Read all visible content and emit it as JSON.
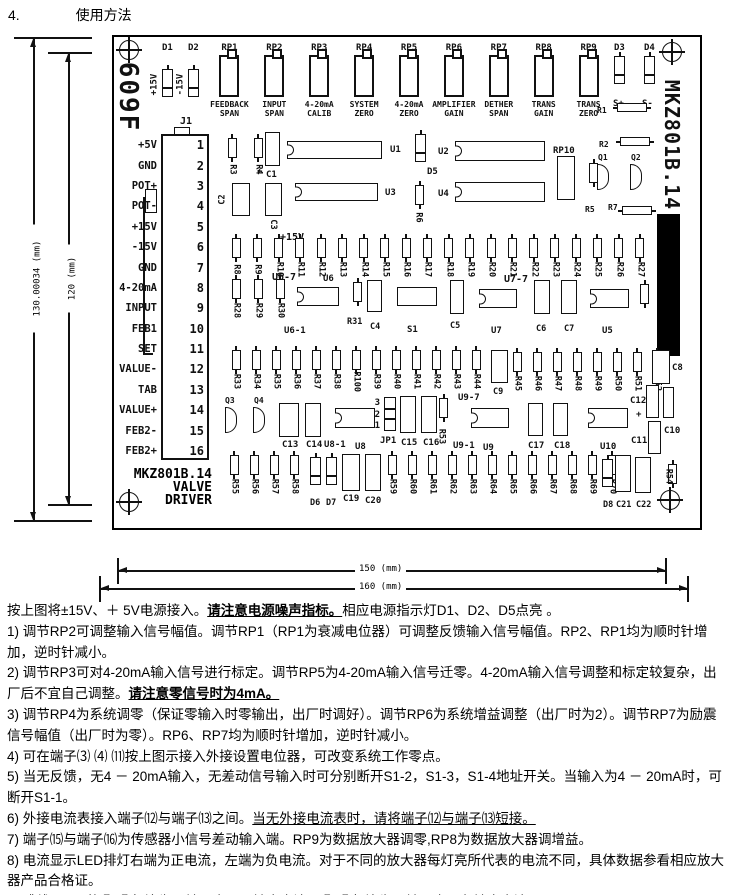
{
  "header": {
    "number": "4.",
    "title": "使用方法"
  },
  "dims": {
    "h_outer": "130.00034 (mm)",
    "h_inner": "120 (mm)",
    "w_inner": "150 (mm)",
    "w_outer": "160 (mm)"
  },
  "board": {
    "side_left": "609F",
    "side_right": "MKZ801B.14",
    "title_block": [
      "MKZ801B.14",
      "VALVE",
      "DRIVER"
    ],
    "l": {
      "d1": "D1",
      "d2": "D2",
      "d3": "D3",
      "d4": "D4",
      "d5": "D5",
      "d6": "D6",
      "d7": "D7",
      "d8": "D8",
      "p15": "+15V",
      "m15": "-15V",
      "p15_mid": "+15V",
      "sp": "S+",
      "sm": "S-",
      "r1": "R1",
      "r2": "R2",
      "r5": "R5",
      "r6": "R6",
      "r7": "R7",
      "r31": "R31",
      "r53": "R53",
      "r54": "R54",
      "rp10": "RP10",
      "q1": "Q1",
      "q2": "Q2",
      "q3": "Q3",
      "q4": "Q4",
      "j1": "J1",
      "jp1": "JP1",
      "s1": "S1",
      "u1": "U1",
      "u2": "U2",
      "u3": "U3",
      "u4": "U4",
      "u5": "U5",
      "u6": "U6",
      "u7": "U7",
      "u8": "U8",
      "u9": "U9",
      "u10": "U10",
      "u6_7": "U6-7",
      "u6_1": "U6-1",
      "u7_7": "U7-7",
      "u8_1": "U8-1",
      "u9_7": "U9-7",
      "u9_1": "U9-1",
      "c1": "C1",
      "c2": "C2",
      "c3": "C3",
      "c4": "C4",
      "c5": "C5",
      "c6": "C6",
      "c7": "C7",
      "c8": "C8",
      "c9": "C9",
      "c10": "C10",
      "c11": "C11",
      "c12": "C12",
      "c13": "C13",
      "c14": "C14",
      "c15": "C15",
      "c16": "C16",
      "c17": "C17",
      "c18": "C18",
      "c19": "C19",
      "c20": "C20",
      "c21": "C21",
      "c22": "C22",
      "plus": "+"
    },
    "jp_pins": [
      "3",
      "2",
      "1"
    ],
    "pots": [
      {
        "name": "RP1",
        "caption": [
          "FEEDBACK",
          "SPAN"
        ]
      },
      {
        "name": "RP2",
        "caption": [
          "INPUT",
          "SPAN"
        ]
      },
      {
        "name": "RP3",
        "caption": [
          "4-20mA",
          "CALIB"
        ]
      },
      {
        "name": "RP4",
        "caption": [
          "SYSTEM",
          "ZERO"
        ]
      },
      {
        "name": "RP5",
        "caption": [
          "4-20mA",
          "ZERO"
        ]
      },
      {
        "name": "RP6",
        "caption": [
          "AMPLIFIER",
          "GAIN"
        ]
      },
      {
        "name": "RP7",
        "caption": [
          "DETHER",
          "SPAN"
        ]
      },
      {
        "name": "RP8",
        "caption": [
          "TRANS",
          "GAIN"
        ]
      },
      {
        "name": "RP9",
        "caption": [
          "TRANS",
          "ZERO"
        ]
      }
    ],
    "j1_pins": [
      {
        "n": "1",
        "label": "+5V"
      },
      {
        "n": "2",
        "label": "GND"
      },
      {
        "n": "3",
        "label": "POT+"
      },
      {
        "n": "4",
        "label": "POT-"
      },
      {
        "n": "5",
        "label": "+15V"
      },
      {
        "n": "6",
        "label": "-15V"
      },
      {
        "n": "7",
        "label": "GND"
      },
      {
        "n": "8",
        "label": "4-20mA"
      },
      {
        "n": "9",
        "label": "INPUT"
      },
      {
        "n": "10",
        "label": "FEB1"
      },
      {
        "n": "11",
        "label": "SET"
      },
      {
        "n": "12",
        "label": "VALUE-"
      },
      {
        "n": "13",
        "label": "TAB"
      },
      {
        "n": "14",
        "label": "VALUE+"
      },
      {
        "n": "15",
        "label": "FEB2-"
      },
      {
        "n": "16",
        "label": "FEB2+"
      }
    ],
    "res_mid": [
      "R3",
      "R4"
    ],
    "res_row1": [
      "R8",
      "R9",
      "R10",
      "R11",
      "R12",
      "R13",
      "R14",
      "R15",
      "R16",
      "R17",
      "R18",
      "R19",
      "R20",
      "R21",
      "R22",
      "R23",
      "R24",
      "R25",
      "R26",
      "R27"
    ],
    "res_row2": [
      "R28",
      "R29",
      "R30"
    ],
    "res_row3a": [
      "R33",
      "R34",
      "R35",
      "R36",
      "R37",
      "R38",
      "R100",
      "R39",
      "R40",
      "R41",
      "R42",
      "R43",
      "R44"
    ],
    "res_row3b": [
      "R45",
      "R46",
      "R47",
      "R48",
      "R49",
      "R50",
      "R51",
      "R52"
    ],
    "res_row4a": [
      "R55",
      "R56",
      "R57",
      "R58"
    ],
    "res_row4b": [
      "R59",
      "R60",
      "R61",
      "R62",
      "R63",
      "R64",
      "R65",
      "R66",
      "R67",
      "R68",
      "R69",
      "R70"
    ]
  },
  "instructions": {
    "intro": {
      "pre": "按上图将±15V、＋ 5V电源接入。",
      "em": "请注意电源噪声指标。",
      "post": "相应电源指示灯D1、D2、D5点亮 。"
    },
    "i1": "1) 调节RP2可调整输入信号幅值。调节RP1（RP1为衰减电位器）可调整反馈输入信号幅值。RP2、RP1均为顺时针增加，逆时针减小。",
    "i2": {
      "pre": "2) 调节RP3可对4-20mA输入信号进行标定。调节RP5为4-20mA输入信号迁零。4-20mA输入信号调整和标定较复杂，出厂后不宜自己调整。",
      "em": "请注意零信号时为4mA。"
    },
    "i3": "3) 调节RP4为系统调零（保证零输入时零输出，出厂时调好）。调节RP6为系统增益调整（出厂时为2）。调节RP7为励震信号幅值（出厂时为零）。RP6、RP7均为顺时针增加，逆时针减小。",
    "i4": "4) 可在端子⑶ ⑷ ⑾按上图示接入外接设置电位器，可改变系统工作零点。",
    "i5": "5) 当无反馈，无4 － 20mA输入，无差动信号输入时可分别断开S1-2，S1-3，S1-4地址开关。当输入为4 － 20mA时，可断开S1-1。",
    "i6": {
      "pre": "6) 外接电流表接入端子⑿与端子⒀之间。",
      "em": "当无外接电流表时，请将端子⑿与端子⒀短接。"
    },
    "i7": "7) 端子⒂与端子⒃为传感器小信号差动输入端。RP9为数据放大器调零,RP8为数据放大器调增益。",
    "i8": "8) 电流显示LED排灯右端为正电流，左端为负电流。对于不同的放大器每灯亮所代表的电流不同，具体数据参看相应放大器产品合格证。",
    "i9": {
      "r1": "9) 跳线器JP1的①-②相连为正输入电压",
      "u1": "正输出电流",
      "r2": "。②-③相连为正输入电压",
      "u2": "负输出电流",
      "r3": "。"
    }
  }
}
